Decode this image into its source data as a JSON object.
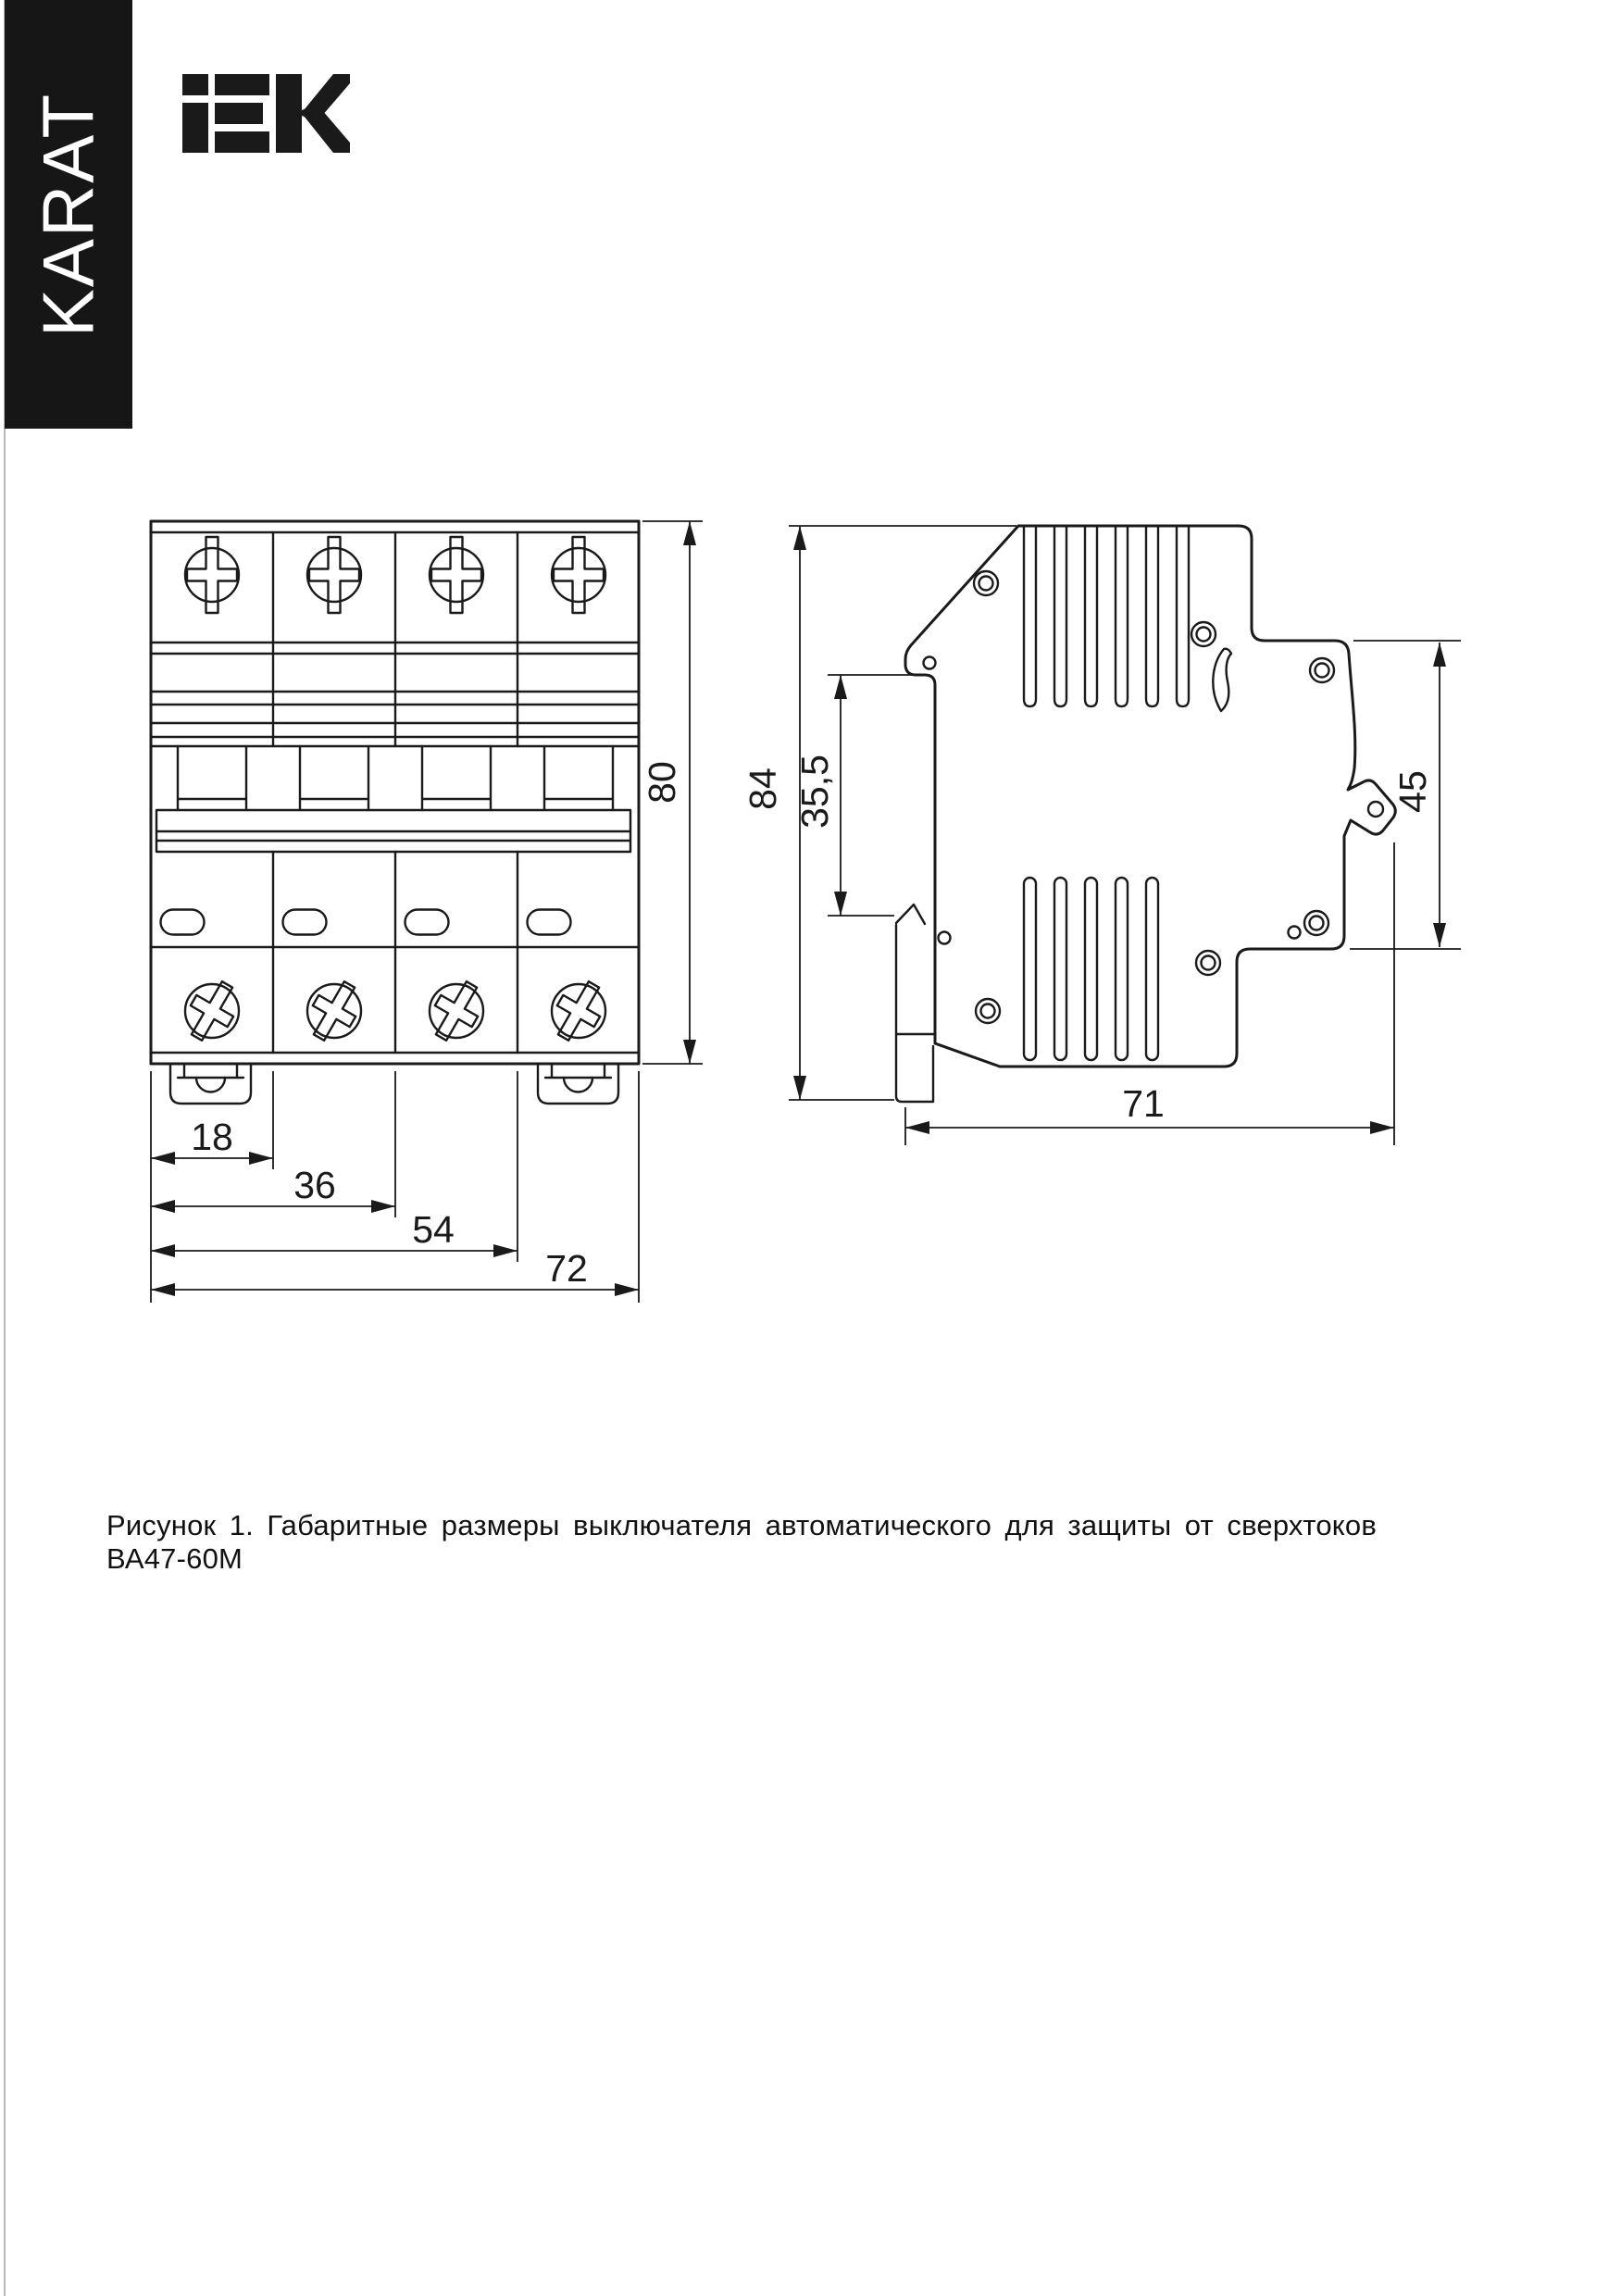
{
  "brand": {
    "sidebar_text": "KARAT",
    "logo_text": "IEK"
  },
  "figure": {
    "caption": "Рисунок 1. Габаритные размеры выключателя автоматического для защиты от сверхтоков ВА47-60М"
  },
  "dimensions": {
    "front_view": {
      "pole_width": "18",
      "two_pole_width": "36",
      "three_pole_width": "54",
      "total_width": "72",
      "height": "80"
    },
    "side_view": {
      "total_height": "84",
      "din_rail_offset": "35,5",
      "front_part_height": "45",
      "depth": "71"
    }
  }
}
